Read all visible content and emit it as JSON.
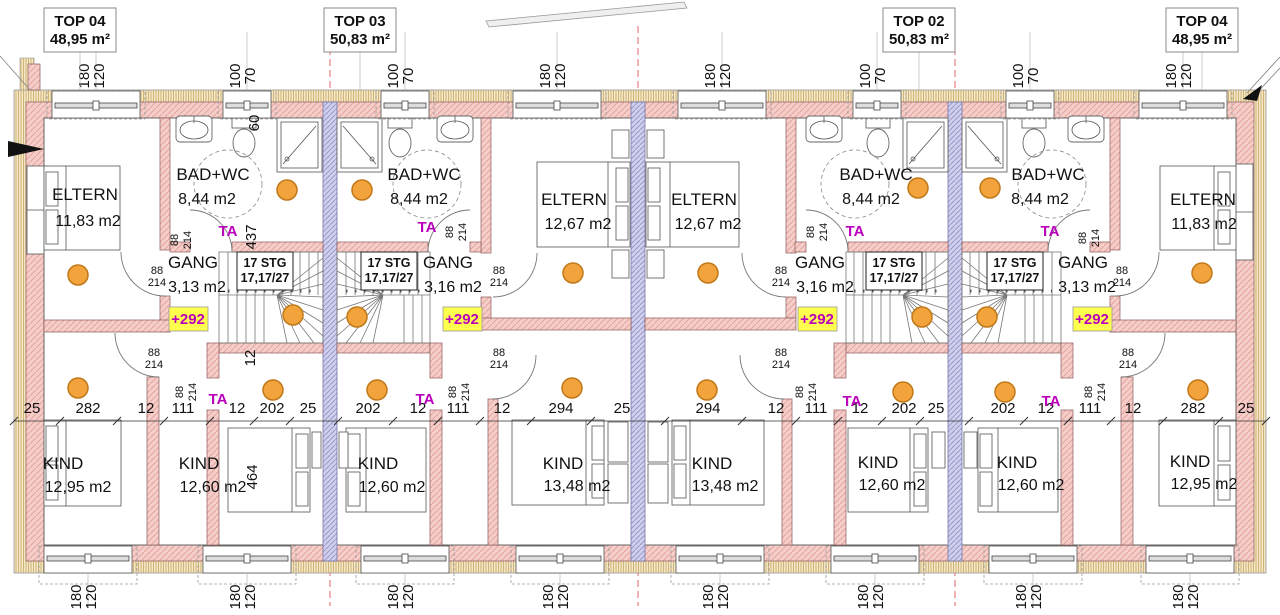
{
  "units": [
    {
      "name": "TOP 04",
      "area": "48,95 m²"
    },
    {
      "name": "TOP 03",
      "area": "50,83 m²"
    },
    {
      "name": "TOP 02",
      "area": "50,83 m²"
    },
    {
      "name": "TOP 04",
      "area": "48,95 m²"
    }
  ],
  "rooms": [
    {
      "name": "ELTERN",
      "area": "11,83 m2"
    },
    {
      "name": "BAD+WC",
      "area": "8,44 m2"
    },
    {
      "name": "BAD+WC",
      "area": "8,44 m2"
    },
    {
      "name": "ELTERN",
      "area": "12,67 m2"
    },
    {
      "name": "ELTERN",
      "area": "12,67 m2"
    },
    {
      "name": "BAD+WC",
      "area": "8,44 m2"
    },
    {
      "name": "BAD+WC",
      "area": "8,44 m2"
    },
    {
      "name": "ELTERN",
      "area": "11,83 m2"
    },
    {
      "name": "GANG",
      "area": "3,13 m2"
    },
    {
      "name": "GANG",
      "area": "3,16 m2"
    },
    {
      "name": "GANG",
      "area": "3,16 m2"
    },
    {
      "name": "GANG",
      "area": "3,13 m2"
    },
    {
      "name": "KIND",
      "area": "12,95 m2"
    },
    {
      "name": "KIND",
      "area": "12,60 m2"
    },
    {
      "name": "KIND",
      "area": "12,60 m2"
    },
    {
      "name": "KIND",
      "area": "13,48 m2"
    },
    {
      "name": "KIND",
      "area": "13,48 m2"
    },
    {
      "name": "KIND",
      "area": "12,60 m2"
    },
    {
      "name": "KIND",
      "area": "12,60 m2"
    },
    {
      "name": "KIND",
      "area": "12,95 m2"
    }
  ],
  "stair": {
    "line1": "17 STG",
    "line2": "17,17/27"
  },
  "level_marker": "+292",
  "door_tag": "TA",
  "dims": {
    "chain": [
      "25",
      "282",
      "12",
      "111",
      "12",
      "202",
      "25",
      "202",
      "12",
      "111",
      "12",
      "294",
      "25",
      "294",
      "12",
      "111",
      "12",
      "202",
      "25",
      "202",
      "12",
      "111",
      "12",
      "282",
      "25"
    ],
    "door": [
      "88",
      "214"
    ],
    "win_large": [
      "180",
      "120"
    ],
    "win_small": [
      "100",
      "70"
    ],
    "v60": "60",
    "v437": "437",
    "v12": "12",
    "v464": "464"
  },
  "colors": {
    "wall_fill": "#F5CECA",
    "wall_hatch": "#E6A49E",
    "insulation_fill": "#F4E7C6",
    "insulation_hatch": "#C8A662",
    "party_wall_fill": "#D0D0EC",
    "party_wall_hatch": "#9898CC",
    "detector_orange": "#F2A33C",
    "marker_yellow": "#FFFF4D",
    "marker_magenta": "#BB00BB",
    "centerline_red": "#E06666"
  }
}
